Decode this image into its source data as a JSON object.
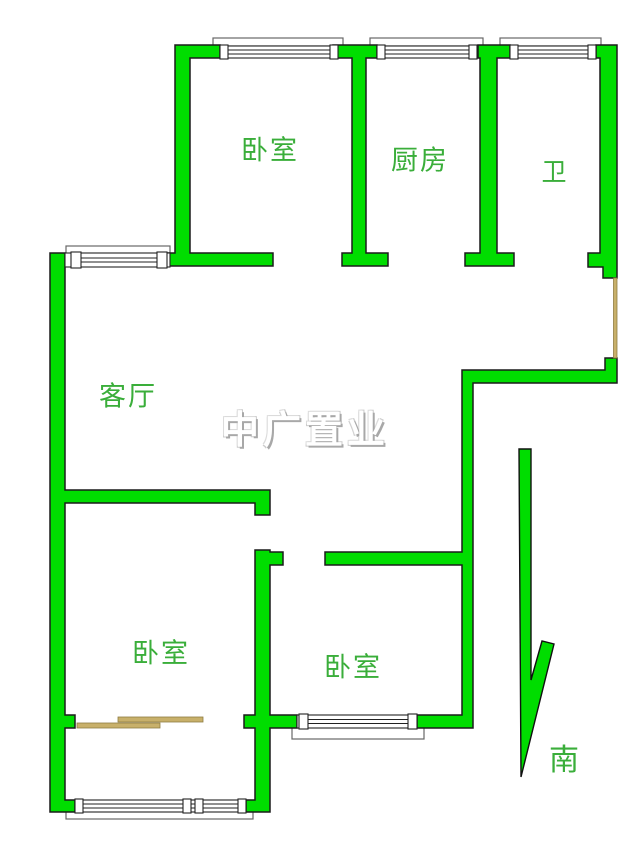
{
  "canvas": {
    "width": 640,
    "height": 841,
    "background": "#ffffff"
  },
  "watermark": {
    "text": "中广置业",
    "color": "#ffffff"
  },
  "compass": {
    "label": "南"
  },
  "palette": {
    "wall": "#00dd00",
    "wall_outline": "#1b1b1b",
    "label_text": "#3aae3a",
    "wood": "#c8b06a",
    "watermark": "#ffffff",
    "page_bg": "#ffffff"
  },
  "rooms": [
    {
      "id": "bedroom-top-left",
      "label": "卧室"
    },
    {
      "id": "kitchen",
      "label": "厨房"
    },
    {
      "id": "bathroom",
      "label": "卫"
    },
    {
      "id": "living-room",
      "label": "客厅"
    },
    {
      "id": "bedroom-bottom-left",
      "label": "卧室"
    },
    {
      "id": "bedroom-bottom-middle",
      "label": "卧室"
    }
  ]
}
